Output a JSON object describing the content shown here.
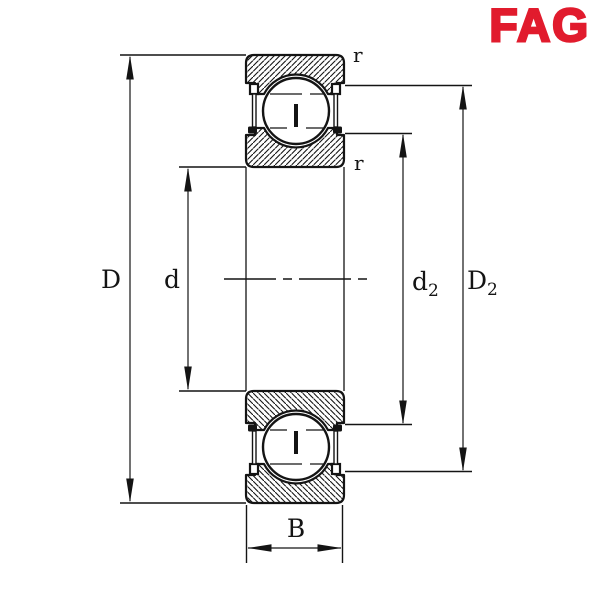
{
  "logo": {
    "text": "FAG",
    "color": "#e11b2d"
  },
  "drawing": {
    "type": "deep-groove-ball-bearing-cross-section",
    "background": "#ffffff",
    "line_color": "#141414",
    "labels": {
      "outside_diameter": "D",
      "bore_diameter": "d",
      "shoulder_diameter_base": "d",
      "shoulder_diameter_sub": "2",
      "recess_diameter_base": "D",
      "recess_diameter_sub": "2",
      "width": "B",
      "chamfer_top": "r",
      "chamfer_bottom": "r"
    }
  }
}
